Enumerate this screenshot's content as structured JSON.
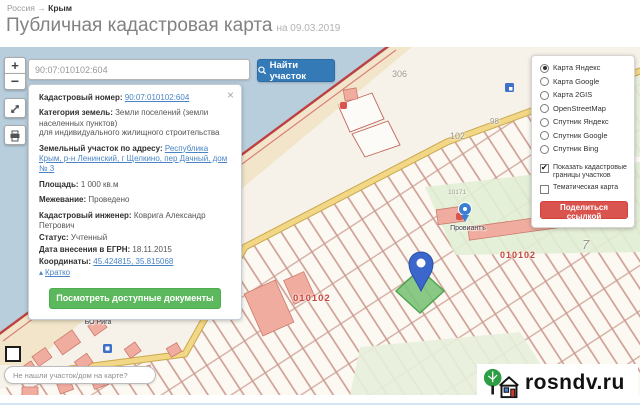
{
  "breadcrumb": {
    "country": "Россия",
    "separator": "→",
    "region": "Крым"
  },
  "header": {
    "title": "Публичная кадастровая карта",
    "date_note": "на 09.03.2019"
  },
  "toolbar": {
    "zoom_in": "+",
    "zoom_out": "−"
  },
  "search": {
    "value": "90:07:010102:604",
    "button_label": "Найти участок"
  },
  "parcel_panel": {
    "close_glyph": "×",
    "rows": [
      {
        "label": "Кадастровый номер:",
        "value": "90:07:010102:604",
        "link": true
      },
      {
        "label": "Категория земель:",
        "value": "Земли поселений (земли населенных пунктов)",
        "link": false
      },
      {
        "note": "для индивидуального жилищного строительства"
      },
      {
        "label": "Земельный участок по адресу:",
        "value": "Республика Крым, р-н Ленинский, г Щелкино, пер Дачный, дом № 3",
        "link": true
      },
      {
        "label": "Площадь:",
        "value": "1 000 кв.м",
        "link": false
      },
      {
        "label": "Межевание:",
        "value": "Проведено",
        "link": false
      },
      {
        "label": "Кадастровый инженер:",
        "value": "Коврига Александр Петрович",
        "link": false
      },
      {
        "label": "Статус:",
        "value": "Учтенный",
        "link": false
      },
      {
        "label": "Дата внесения в ЕГРН:",
        "value": "18.11.2015",
        "link": false
      },
      {
        "label": "Координаты:",
        "value": "45.424815, 35.815068",
        "link": true
      }
    ],
    "collapse_arrow_glyph": "▴",
    "collapse_label": "Кратко",
    "documents_button": "Посмотреть доступные документы"
  },
  "layers_panel": {
    "check_glyph": "✔",
    "base_layers": [
      {
        "label": "Карта Яндекс",
        "selected": true
      },
      {
        "label": "Карта Google",
        "selected": false
      },
      {
        "label": "Карта 2GIS",
        "selected": false
      },
      {
        "label": "OpenStreetMap",
        "selected": false
      },
      {
        "label": "Спутник Яндекс",
        "selected": false
      },
      {
        "label": "Спутник Google",
        "selected": false
      },
      {
        "label": "Спутник Bing",
        "selected": false
      }
    ],
    "overlays": [
      {
        "label": "Показать кадастровые границы участков",
        "checked": true
      },
      {
        "label": "Тематическая карта",
        "checked": false
      }
    ],
    "share_button": "Поделиться ссылкой"
  },
  "map": {
    "labels": [
      {
        "text": "306"
      },
      {
        "text": "98"
      },
      {
        "text": "102"
      },
      {
        "text": "10171"
      },
      {
        "text": "7"
      },
      {
        "text": "7"
      },
      {
        "text": "010102"
      },
      {
        "text": "010102"
      }
    ],
    "pois": [
      {
        "name": "Провиантъ"
      },
      {
        "name": "Казантип"
      },
      {
        "name": "БО Рига"
      }
    ]
  },
  "bottom_bar": {
    "find_placeholder": "Не нашли участок/дом на карте?"
  },
  "logo": {
    "text": "rosndv.ru"
  },
  "colors": {
    "primary": "#337ab7",
    "success": "#5cb85c",
    "danger": "#d9534f",
    "link": "#4a84c4",
    "water": "#b9cedd",
    "land": "#f7f2e9",
    "parcel_border": "#c79287"
  }
}
